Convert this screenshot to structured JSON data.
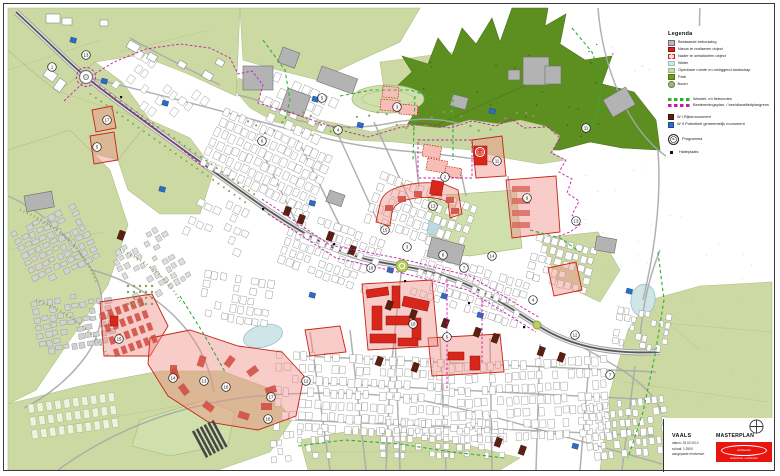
{
  "sheet": {
    "title": "Masterplan Vaals"
  },
  "legend": {
    "title": "Legenda",
    "items": [
      {
        "swatch": "rect",
        "fill": "#b9b9b9",
        "stroke": "#6e6e6e",
        "label": "Bestaande bebouwing"
      },
      {
        "swatch": "rect",
        "fill": "#d8261b",
        "stroke": "#8c140e",
        "label": "Nieuw te realiseren object"
      },
      {
        "swatch": "rect-dashed",
        "fill": "#f9ddda",
        "stroke": "#c62517",
        "label": "Nader te ontwikkelen object"
      },
      {
        "swatch": "rect",
        "fill": "#cfe5e8",
        "stroke": "#8cc0cc",
        "label": "Water"
      },
      {
        "swatch": "rect",
        "fill": "#cdd9a3",
        "stroke": "#9fb177",
        "label": "Openbare ruimte en omliggend landschap"
      },
      {
        "swatch": "rect",
        "fill": "#6f9a2a",
        "stroke": "#4f711c",
        "label": "Park"
      },
      {
        "swatch": "circle",
        "fill": "#9ab873",
        "stroke": "#5e7f42",
        "label": "Boom"
      }
    ],
    "lines": [
      {
        "color": "#2fae35",
        "label": "Wandel- en fietsroutes"
      },
      {
        "color": "#c819ae",
        "label": "Bestemmingsplan- / beeldkwaliteitplangrens"
      }
    ],
    "monuments": [
      {
        "fill": "#5c2012",
        "stroke": "#3c130a",
        "label": "W I  Rijksmonument"
      },
      {
        "fill": "#2c6cc4",
        "stroke": "#1d4a8c",
        "label": "W II  Potentieel gemeentelijk monument"
      }
    ],
    "symbols": [
      {
        "type": "circle-number",
        "glyph": "nr.",
        "label": "Programma"
      },
      {
        "type": "square",
        "label": "Halteplaats"
      }
    ]
  },
  "titleblock": {
    "project": "VAALS",
    "date_label": "datum: 25.02.2013",
    "scale_label": "schaal: 1:2500",
    "status_label": "aangepaste eindversie",
    "plan_title": "MASTERPLAN",
    "logo_line1": "architecten",
    "logo_line2": "stedenbouw + architectuur"
  },
  "map": {
    "colors": {
      "field": "#cdd9a3",
      "field_edge": "#aebf86",
      "park": "#cfe0ac",
      "forest": "#5c8e20",
      "water": "#cfe5e8",
      "water_edge": "#8cc0cc",
      "road_band": "#e8e8e8",
      "road_edge": "#9a9a9a",
      "road_core": "#585858",
      "minor_road": "#a8a8a8",
      "building": "#ffffff",
      "building_edge": "#999999",
      "gray_building": "#b3b3b3",
      "zone_fill": "#ef8d84",
      "zone_stroke": "#c62517",
      "zone_building": "#cf4a40",
      "new_building": "#d8261b",
      "planned_fill": "#f6beb7",
      "monument_r": "#5c2012",
      "monument_g": "#2c6cc4",
      "boundary": "#c819ae",
      "route": "#2fae35",
      "tree": "#7fa653",
      "roundabout": "#b9cf62"
    },
    "markers": [
      {
        "n": "13",
        "x": 86,
        "y": 55
      },
      {
        "n": "1",
        "x": 52,
        "y": 67
      },
      {
        "n": "17",
        "x": 107,
        "y": 120
      },
      {
        "n": "5",
        "x": 97,
        "y": 147
      },
      {
        "n": "6",
        "x": 262,
        "y": 141
      },
      {
        "n": "5",
        "x": 322,
        "y": 98
      },
      {
        "n": "4",
        "x": 338,
        "y": 130
      },
      {
        "n": "3",
        "x": 397,
        "y": 107
      },
      {
        "n": "2",
        "x": 445,
        "y": 177
      },
      {
        "n": "11",
        "x": 497,
        "y": 161
      },
      {
        "n": "13",
        "x": 433,
        "y": 206
      },
      {
        "n": "9",
        "x": 527,
        "y": 198
      },
      {
        "n": "11",
        "x": 586,
        "y": 128
      },
      {
        "n": "13",
        "x": 576,
        "y": 221
      },
      {
        "n": "15",
        "x": 385,
        "y": 230
      },
      {
        "n": "18",
        "x": 371,
        "y": 268
      },
      {
        "n": "3",
        "x": 407,
        "y": 247
      },
      {
        "n": "8",
        "x": 443,
        "y": 255
      },
      {
        "n": "7",
        "x": 464,
        "y": 268
      },
      {
        "n": "14",
        "x": 492,
        "y": 256
      },
      {
        "n": "15",
        "x": 119,
        "y": 339
      },
      {
        "n": "14",
        "x": 173,
        "y": 378
      },
      {
        "n": "13",
        "x": 204,
        "y": 381
      },
      {
        "n": "16",
        "x": 226,
        "y": 387
      },
      {
        "n": "17",
        "x": 271,
        "y": 397
      },
      {
        "n": "18",
        "x": 268,
        "y": 419
      },
      {
        "n": "12",
        "x": 306,
        "y": 381
      },
      {
        "n": "10",
        "x": 413,
        "y": 324
      },
      {
        "n": "5",
        "x": 447,
        "y": 337
      },
      {
        "n": "4",
        "x": 533,
        "y": 300
      },
      {
        "n": "12",
        "x": 575,
        "y": 335
      },
      {
        "n": "7",
        "x": 610,
        "y": 375
      }
    ],
    "accent_marker": {
      "n": "13",
      "x": 480,
      "y": 152
    }
  }
}
